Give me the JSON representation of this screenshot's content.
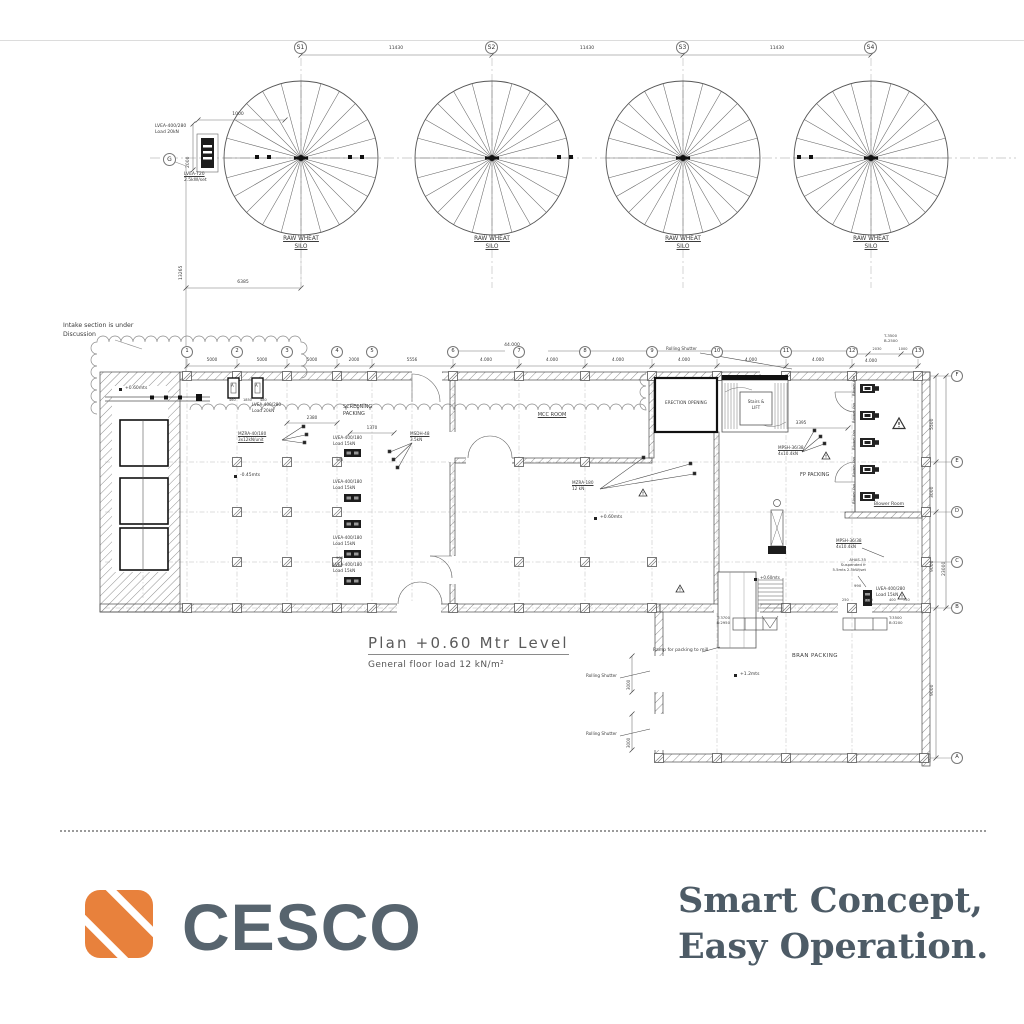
{
  "silos": {
    "markers": [
      "S1",
      "S2",
      "S3",
      "S4"
    ],
    "spacings": [
      "11430",
      "11430",
      "11430"
    ],
    "silo_name_l1": "RAW WHEAT",
    "silo_name_l2": "SILO",
    "left_marker": "G",
    "hopper_l1": "LVEA-400/280",
    "hopper_l2": "Load 20kN",
    "feeder_l1": "LVEA-T20",
    "feeder_l2": "2.5kW/set",
    "dim_width": "1000",
    "dim_height": "2000",
    "dim_drop": "13265",
    "dim_offset": "6385"
  },
  "plan": {
    "note_l1": "Intake section is under",
    "note_l2": "Discussion",
    "grid_cols": [
      "1",
      "2",
      "3",
      "4",
      "5",
      "6",
      "7",
      "8",
      "9",
      "10",
      "11",
      "12",
      "13"
    ],
    "grid_rows": [
      "F",
      "E",
      "D",
      "C",
      "B",
      "A"
    ],
    "top_dims": [
      "5000",
      "5000",
      "5000",
      "2000",
      "5556",
      "4.000",
      "4.000",
      "4.000",
      "4.000",
      "4.000",
      "4.000"
    ],
    "dim_12_13": "4.000",
    "sub_dims": [
      "1000",
      "2030",
      "1000"
    ],
    "top_overall": "44.000",
    "col13_t": "T-3500",
    "col13_b": "B-2500",
    "right_dims": {
      "fe": "5500",
      "ed": "3000",
      "db": "9000",
      "ba": "9000",
      "overall": "23000"
    },
    "rooms": {
      "screening_l1": "SCREENING",
      "screening_l2": "PACKING",
      "mcc": "MCC ROOM",
      "erection": "ERECTION OPENING",
      "stairs_l1": "Stairs &",
      "stairs_l2": "LIFT",
      "fp": "FP PACKING",
      "blower": "Blower Room",
      "bran": "BRAN PACKING"
    },
    "levels": {
      "l1": "+0.60mts",
      "l2": "-0.45mts",
      "l3": "+0.60mts",
      "l4": "+0.60mts",
      "l5": "+1.2mts"
    },
    "equip": {
      "fan_a": "A",
      "lvea_top_l1": "LVEA-400/280",
      "lvea_top_l2": "Load 20kN",
      "mzra40_l1": "MZRA-40/180",
      "mzra40_l2": "3x12kN/unit",
      "msdh_l1": "MSDH-48",
      "msdh_l2": "3.5kN",
      "mzra180_l1": "MZRA-180",
      "mzra180_l2": "12 kN",
      "mpsh_l1": "MPSH-36/38",
      "mpsh_l2": "4x10.4kN",
      "ahas_l1": "AHAS-35",
      "ahas_l2": "Suspended fr",
      "ahas_l3": "5.5mts 2.5kW/set",
      "lvea_br_l1": "LVEA-400/280",
      "lvea_br_l2": "Load 15kN",
      "lvea_unit_l1": "LVEA-400/180",
      "lvea_unit_l2": "Load 15kN",
      "blower_fan": "Blower fan",
      "tb_left_t": "T:3700",
      "tb_left_b": "B:2950",
      "tb_right_t": "T:3500",
      "tb_right_b": "B:3200"
    },
    "labels": {
      "rolling_shutter": "Rolling Shutter",
      "ramp": "Ramp for packing to mill"
    },
    "dims": {
      "d2380": "2380",
      "d1370": "1370",
      "d3395": "3395",
      "d900": "900",
      "d990": "990",
      "d250": "250",
      "d2750": "2750",
      "d400": "400",
      "d750": "750",
      "d3000": "3000",
      "d460": "460",
      "d1850": "1850",
      "d480": "480"
    },
    "title": "Plan +0.60 Mtr Level",
    "subtitle": "General floor load 12 kN/m²"
  },
  "footer": {
    "brand": "CESCO",
    "tagline_l1": "Smart Concept,",
    "tagline_l2": "Easy Operation."
  }
}
